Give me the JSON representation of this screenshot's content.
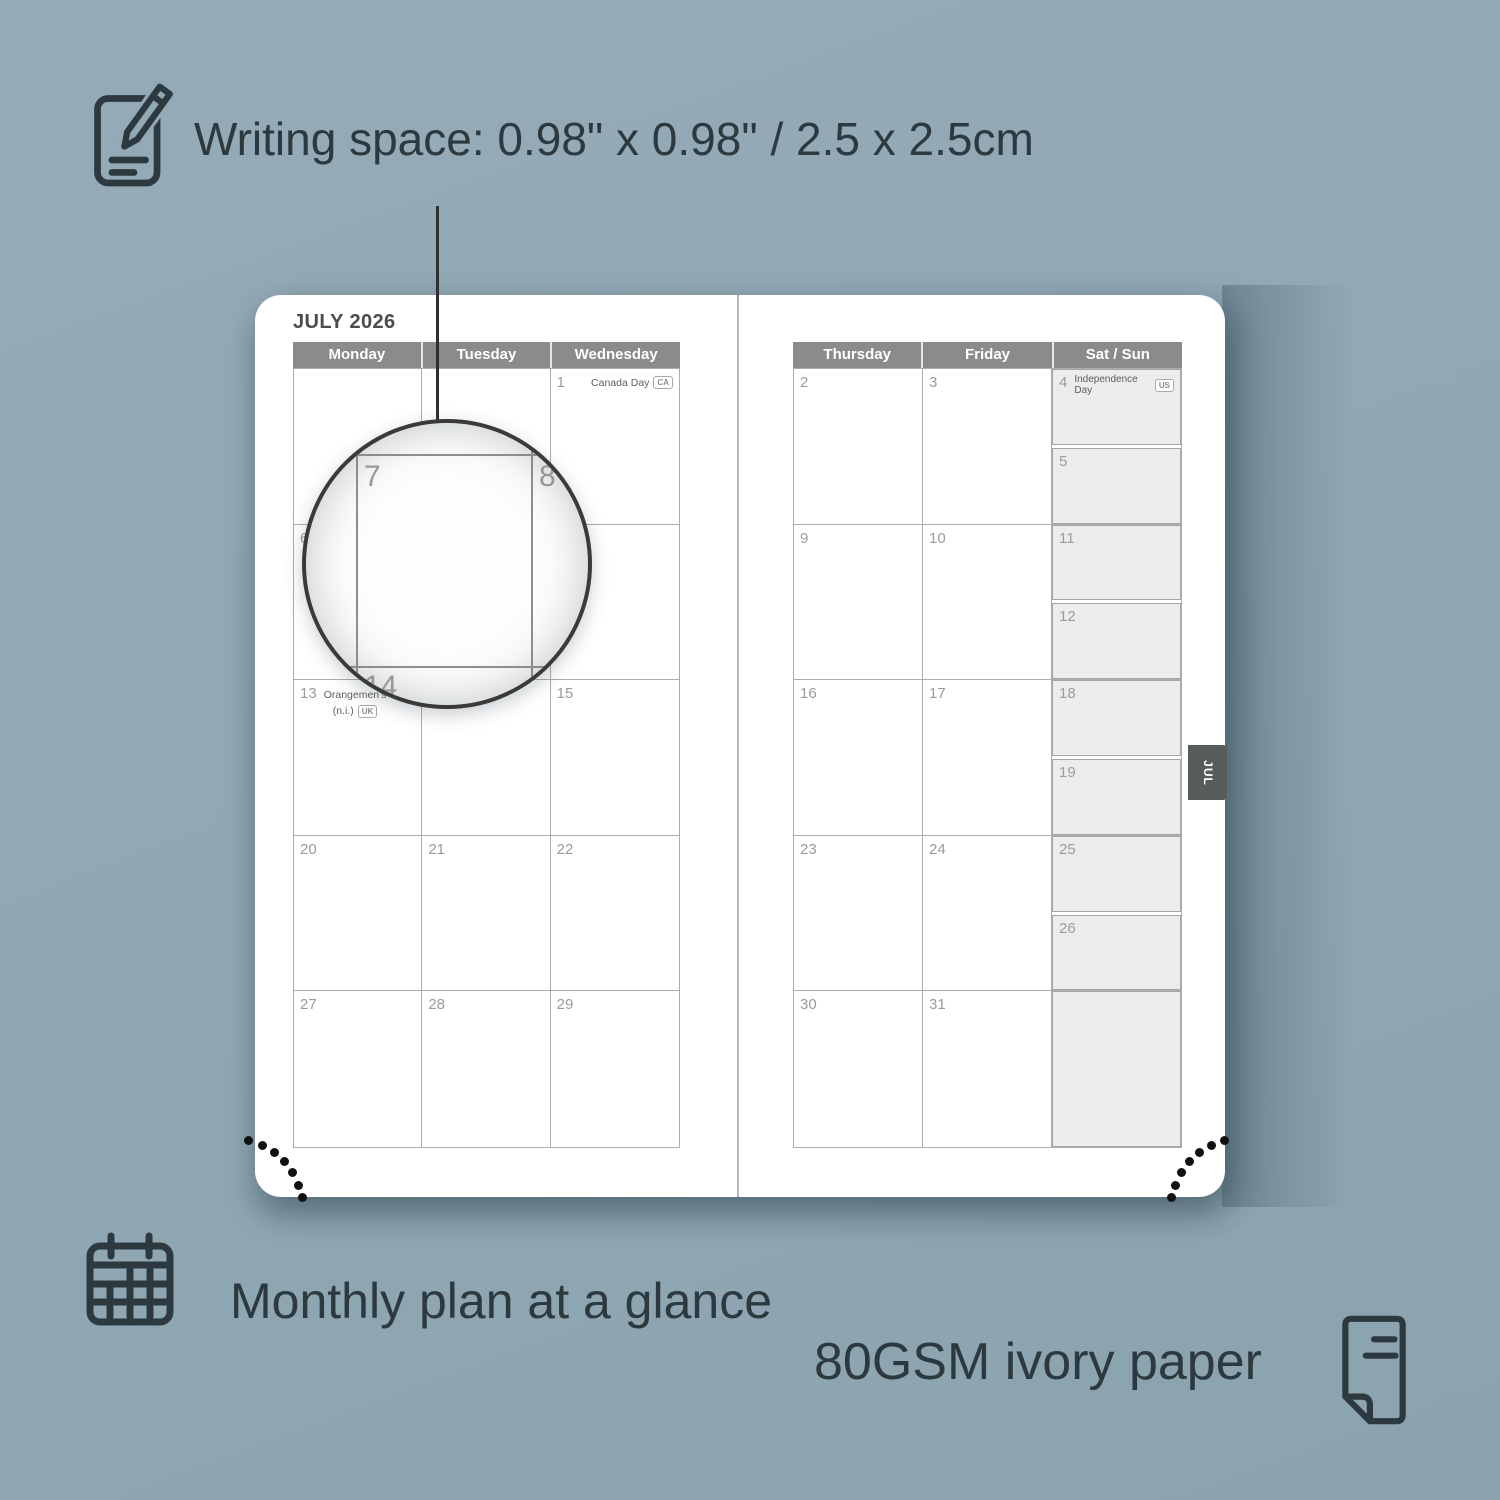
{
  "annotations": {
    "writing_space": "Writing space: 0.98\" x 0.98\" / 2.5 x 2.5cm",
    "monthly_plan": "Monthly plan at a glance",
    "paper": "80GSM ivory paper"
  },
  "planner": {
    "title": "JULY 2026",
    "tab_label": "JUL",
    "left_headers": [
      "Monday",
      "Tuesday",
      "Wednesday"
    ],
    "right_headers": [
      "Thursday",
      "Friday",
      "Sat / Sun"
    ],
    "left_rows": [
      [
        {
          "d": ""
        },
        {
          "d": ""
        },
        {
          "d": "1",
          "holiday": "Canada Day",
          "badge": "CA"
        }
      ],
      [
        {
          "d": "6"
        },
        {
          "d": "7"
        },
        {
          "d": "8"
        }
      ],
      [
        {
          "d": "13",
          "holiday": "Orangemen's",
          "holiday_line2": "(n.i.)",
          "badge": "UK"
        },
        {
          "d": "14"
        },
        {
          "d": "15"
        }
      ],
      [
        {
          "d": "20"
        },
        {
          "d": "21"
        },
        {
          "d": "22"
        }
      ],
      [
        {
          "d": "27"
        },
        {
          "d": "28"
        },
        {
          "d": "29"
        }
      ]
    ],
    "right_rows": [
      {
        "thu": "2",
        "fri": "3",
        "sat": "4",
        "sat_holiday": "Independence Day",
        "sat_badge": "US",
        "sun": "5"
      },
      {
        "thu": "9",
        "fri": "10",
        "sat": "11",
        "sun": "12"
      },
      {
        "thu": "16",
        "fri": "17",
        "sat": "18",
        "sun": "19"
      },
      {
        "thu": "23",
        "fri": "24",
        "sat": "25",
        "sun": "26"
      },
      {
        "thu": "30",
        "fri": "31",
        "sat": "",
        "sun": ""
      }
    ],
    "magnifier": {
      "top_left": "7",
      "top_right": "8",
      "bottom": "14"
    }
  },
  "colors": {
    "background": "#90a7b4",
    "accent_dark": "#2c3a40",
    "header_gray": "#8b8b8b",
    "grid_line": "#aeadad",
    "day_number": "#9b9b9b",
    "satsun_fill": "#ececec",
    "tab_gray": "#575c59",
    "page_white": "#ffffff"
  }
}
